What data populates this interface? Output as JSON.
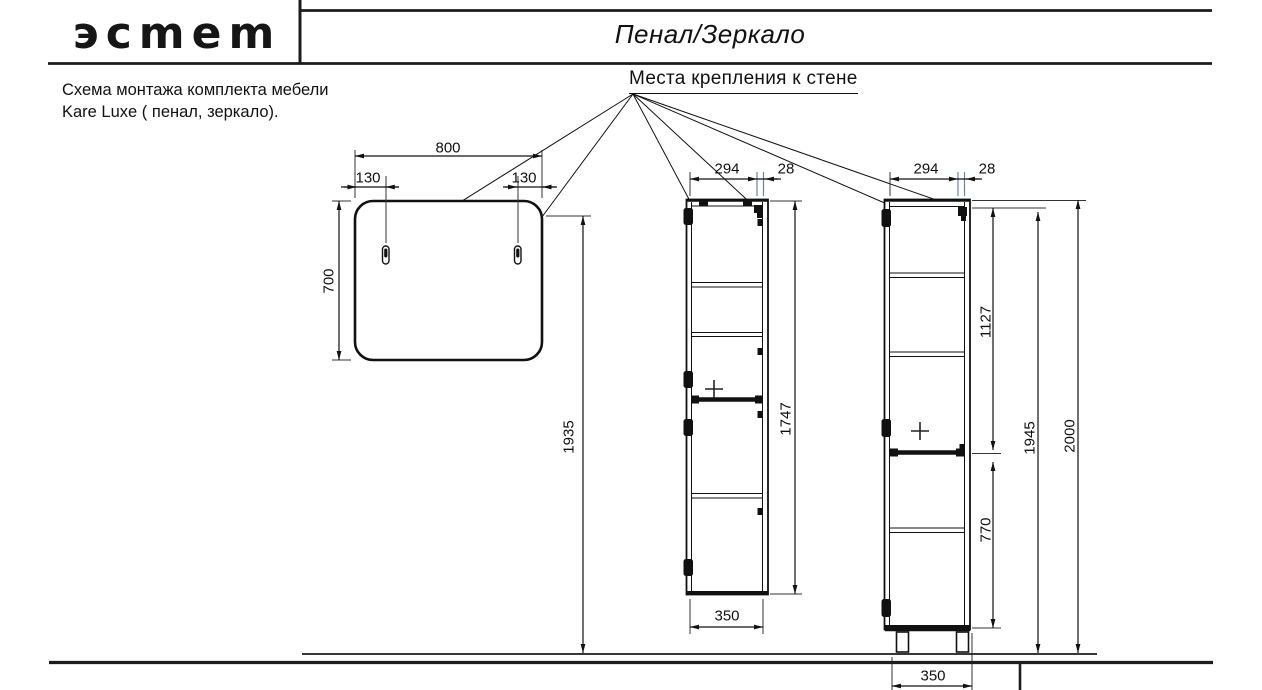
{
  "header": {
    "logo_text": "эсmem",
    "sheet_title": "Пенал/Зеркало"
  },
  "note": {
    "line1": "Схема монтажа комплекта мебели",
    "line2": "Kare Luxe ( пенал, зеркало)."
  },
  "callout": {
    "label": "Места крепления к стене"
  },
  "dimensions": {
    "mirror_width": "800",
    "mirror_hanger_left": "130",
    "mirror_hanger_right": "130",
    "mirror_height": "700",
    "mirror_mount_height": "1935",
    "wall_cabinet_bracket_span": "294",
    "wall_cabinet_bracket_offset": "28",
    "wall_cabinet_height": "1747",
    "wall_cabinet_width": "350",
    "floor_cabinet_bracket_span": "294",
    "floor_cabinet_bracket_offset": "28",
    "floor_cabinet_upper_bracket": "1127",
    "floor_cabinet_mount_height": "1945",
    "floor_cabinet_total_height": "2000",
    "floor_cabinet_lower_bracket": "770",
    "floor_cabinet_width": "350"
  },
  "colors": {
    "ink": "#111111",
    "extension_accent": "#6e8299"
  }
}
